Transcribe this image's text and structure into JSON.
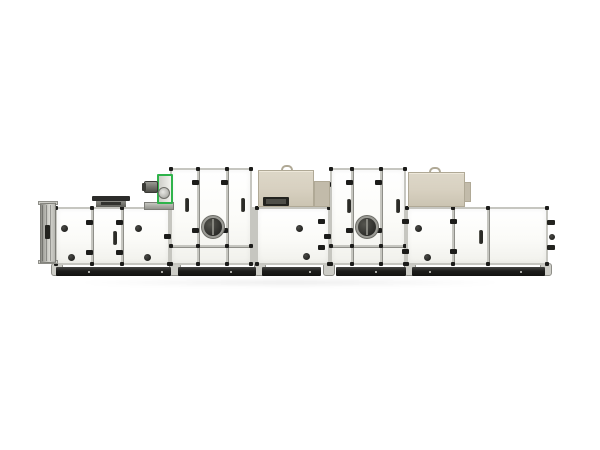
{
  "image_description": "Product photograph of a long modular industrial air handling unit (AHU) on a white background: white panel sections with grey frames, black door knobs and hinges, two inspection portholes, a green-framed blower with motor, two beige roof-mounted boxes, an inlet louver flange on the left and a dark plinth base with feet.",
  "background_color": "#ffffff",
  "palette": {
    "panel": "#fbfbf8",
    "panel_shade": "#f1f1ec",
    "frame": "#c6c6c0",
    "frame_dark": "#8f8f89",
    "cap": "#1c1c1a",
    "base_dark": "#1d1d1b",
    "base_light": "#454543",
    "foot": "#cdcdc7",
    "beige": "#d8d1c1",
    "beige_dark": "#c2bbaa",
    "beige_edge": "#b0a996",
    "slot_dark": "#23231f",
    "green": "#2fb34b",
    "metal": "#9a9a94",
    "metal_dark": "#4e4e48",
    "glass": "#1c1c1a",
    "knob": "#141412",
    "bolt": "#d8d8d2"
  },
  "machine": {
    "sections": [
      {
        "name": "unit-section-1",
        "x": 55,
        "y": 207,
        "w": 115,
        "h": 58,
        "dividers": [
          92,
          122
        ],
        "hband": null,
        "handles": [
          [
            115,
            238
          ]
        ],
        "knobs": [
          [
            64,
            228
          ],
          [
            71,
            257
          ],
          [
            138,
            228
          ],
          [
            147,
            257
          ]
        ],
        "hinges": [
          [
            92,
            222
          ],
          [
            92,
            252
          ],
          [
            122,
            222
          ],
          [
            122,
            252
          ]
        ],
        "porthole": null
      },
      {
        "name": "unit-section-2-tall",
        "x": 170,
        "y": 168,
        "w": 82,
        "h": 97,
        "dividers": [
          198,
          227
        ],
        "hband": 246,
        "handles": [
          [
            187,
            205
          ],
          [
            243,
            205
          ]
        ],
        "knobs": [],
        "hinges": [
          [
            170,
            184
          ],
          [
            170,
            236
          ],
          [
            198,
            182
          ],
          [
            198,
            230
          ],
          [
            227,
            182
          ],
          [
            227,
            230
          ]
        ],
        "porthole": [
          213,
          227,
          9
        ]
      },
      {
        "name": "unit-section-3",
        "x": 256,
        "y": 207,
        "w": 74,
        "h": 58,
        "dividers": [],
        "hband": null,
        "handles": [],
        "knobs": [
          [
            299,
            228
          ],
          [
            306,
            256
          ]
        ],
        "hinges": [
          [
            324,
            221
          ],
          [
            324,
            247
          ]
        ],
        "porthole": null
      },
      {
        "name": "unit-section-4-tall",
        "x": 330,
        "y": 168,
        "w": 76,
        "h": 97,
        "dividers": [
          352,
          381
        ],
        "hband": 246,
        "handles": [
          [
            349,
            206
          ],
          [
            398,
            206
          ]
        ],
        "knobs": [],
        "hinges": [
          [
            330,
            184
          ],
          [
            330,
            236
          ],
          [
            352,
            182
          ],
          [
            352,
            230
          ],
          [
            381,
            182
          ],
          [
            381,
            230
          ]
        ],
        "porthole": [
          367,
          227,
          9
        ]
      },
      {
        "name": "unit-section-5",
        "x": 406,
        "y": 207,
        "w": 142,
        "h": 58,
        "dividers": [
          453,
          488
        ],
        "hband": null,
        "handles": [
          [
            481,
            237
          ]
        ],
        "knobs": [
          [
            418,
            228
          ],
          [
            427,
            257
          ]
        ],
        "hinges": [
          [
            408,
            221
          ],
          [
            408,
            251
          ],
          [
            456,
            221
          ],
          [
            456,
            251
          ]
        ],
        "porthole": null
      }
    ],
    "backplates": [
      {
        "name": "frame-backplate-low",
        "x": 55,
        "y": 207,
        "w": 493,
        "h": 58
      },
      {
        "name": "frame-backplate-tall-1",
        "x": 170,
        "y": 168,
        "w": 82,
        "h": 97
      },
      {
        "name": "frame-backplate-tall-2",
        "x": 330,
        "y": 168,
        "w": 76,
        "h": 97
      }
    ],
    "base": {
      "y": 267,
      "h": 9,
      "segments": [
        [
          56,
          171
        ],
        [
          178,
          256
        ],
        [
          262,
          321
        ],
        [
          336,
          406
        ],
        [
          412,
          545
        ]
      ],
      "joints": [
        56,
        174,
        259,
        328,
        409,
        545
      ],
      "bolts": [
        88,
        161,
        230,
        309,
        375,
        429,
        520
      ]
    },
    "inlet_louver": {
      "x": 40,
      "y": 203,
      "w": 16,
      "h": 60,
      "slot": [
        45,
        225,
        5,
        14
      ]
    },
    "roof_vent": {
      "cap": [
        92,
        196,
        38,
        5
      ],
      "body": [
        96,
        201,
        30,
        6
      ],
      "slot": [
        101,
        202,
        20,
        3
      ]
    },
    "fan_unit": {
      "bracket": [
        144,
        202,
        30,
        8
      ],
      "green_frame": [
        157,
        174,
        16,
        30
      ],
      "scroll": [
        158,
        187,
        12
      ],
      "motor": [
        144,
        181,
        14,
        12
      ],
      "motor_cap": [
        142,
        183,
        4,
        8
      ]
    },
    "roof_boxes": [
      {
        "name": "roof-box-1",
        "box": [
          258,
          170,
          56,
          37
        ],
        "wing": [
          314,
          181,
          16,
          26
        ],
        "slot": [
          263,
          197,
          26,
          9
        ],
        "slot_inner": [
          266,
          199,
          20,
          5
        ],
        "handle": [
          281,
          165,
          12,
          6
        ]
      },
      {
        "name": "roof-box-2",
        "box": [
          408,
          172,
          57,
          35
        ],
        "wing": [
          464,
          182,
          7,
          20
        ],
        "slot": null,
        "slot_inner": null,
        "handle": [
          429,
          167,
          12,
          6
        ]
      }
    ],
    "right_fittings": {
      "tabs": [
        [
          547,
          220
        ],
        [
          547,
          245
        ]
      ],
      "knob": [
        552,
        237
      ]
    },
    "shadow": {
      "x": 70,
      "y": 279,
      "w": 440,
      "h": 7
    }
  }
}
